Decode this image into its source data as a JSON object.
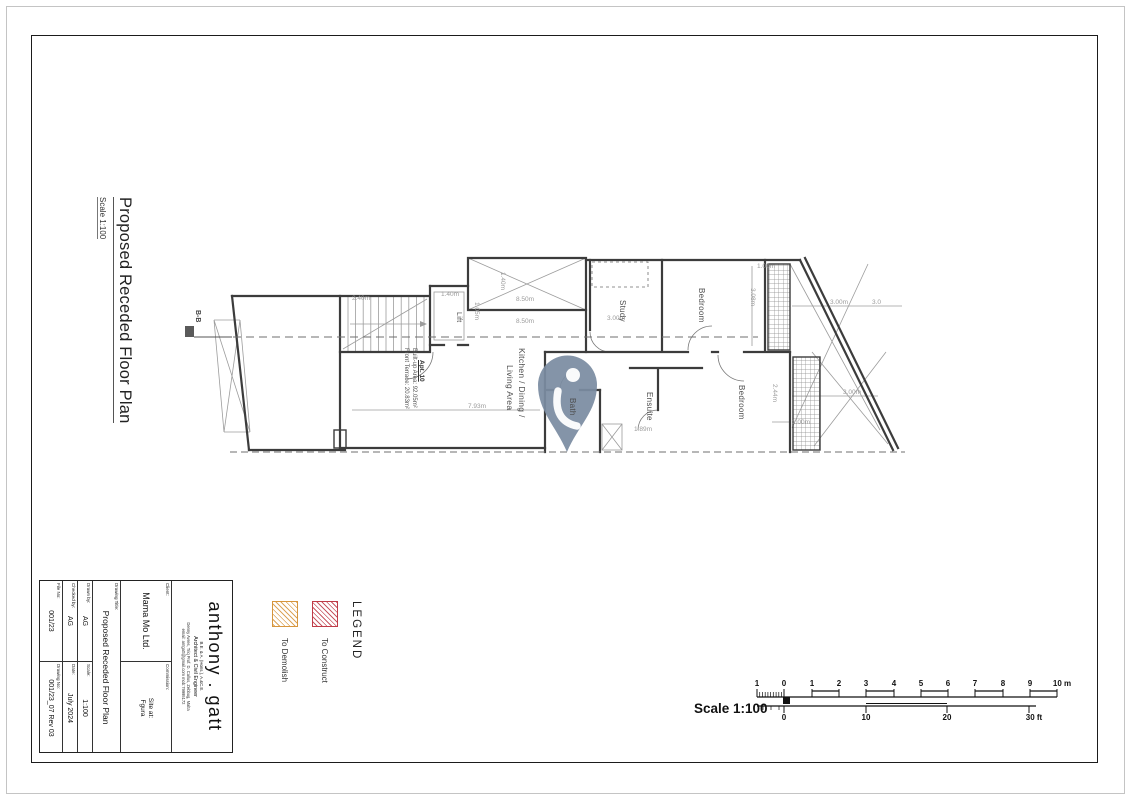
{
  "drawing": {
    "title": "Proposed Receded Floor Plan",
    "scale_note": "Scale 1:100",
    "section_label": "B-B"
  },
  "plan": {
    "rooms": {
      "lift": "Lift",
      "kitchen_line1": "Kitchen / Dining /",
      "kitchen_line2": "Living Area",
      "study": "Study",
      "bedroom_top": "Bedroom",
      "bath": "Bath",
      "ensuite": "Ensuite",
      "bedroom_bottom": "Bedroom"
    },
    "apartment": {
      "name": "Apt. 10",
      "built_up_area": "Built-up Area: 92.05m²",
      "front_terrace": "Front Terrace: 20.83m²"
    },
    "dimensions": {
      "shaft_width": "8.50m",
      "kitchen_width": "8.50m",
      "shaft_depth": "1.40m",
      "lift_width": "1.40m",
      "lift_depth": "1.05m",
      "stairs_width": "2.40m",
      "kitchen_length": "7.93m",
      "study_width": "3.00m",
      "bedroom_top_depth": "3.08m",
      "balcony_top_width": "1.00m",
      "terrace_width_a": "3.00m",
      "terrace_width_b": "3.0",
      "terrace_width_c": "3.00m",
      "bedroom_bottom_depth": "2.44m",
      "balcony_bottom_width": "1.00m",
      "ensuite_width": "1.89m"
    },
    "watermark_color": "#7b8ca1"
  },
  "legend": {
    "title": "LEGEND",
    "construct_label": "To Construct",
    "demolish_label": "To Demolish",
    "construct_color": "#bf3b47",
    "demolish_color": "#d6953c"
  },
  "scalebar": {
    "caption": "Scale 1:100",
    "m_ticks": [
      "1",
      "0",
      "1",
      "2",
      "3",
      "4",
      "5",
      "6",
      "7",
      "8",
      "9"
    ],
    "m_unit": "10 m",
    "ft_ticks": [
      "0",
      "10",
      "20"
    ],
    "ft_unit": "30 ft"
  },
  "titleblock": {
    "architect": {
      "name": "anthony . gatt",
      "credentials": "B.E. & A. (Hons.), A.&C.E.",
      "profession": "Architect & Civil Engineer",
      "address": "Denny Avres, Triq Prof. D. Callus, Zebbug, Malta",
      "contact": "email: antgatt@gmail.com   mob:79995172"
    },
    "client_label": "Client:",
    "client": "Mama Mo Ltd.",
    "commission_label": "Commission:",
    "commission_line1": "Site at:",
    "commission_line2": "Fgura",
    "drawing_title_label": "Drawing Title:",
    "drawing_title": "Proposed Receded Floor Plan",
    "drawn_label": "Drawn by:",
    "drawn": "AG",
    "scale_label": "Scale:",
    "scale": "1:100",
    "checked_label": "Checked by:",
    "checked": "AG",
    "date_label": "Date:",
    "date": "July 2024",
    "file_no_label": "File No:",
    "file_no": "001/23",
    "drawing_no_label": "Drawing No:",
    "drawing_no": "001/23_07 Rev 03"
  }
}
